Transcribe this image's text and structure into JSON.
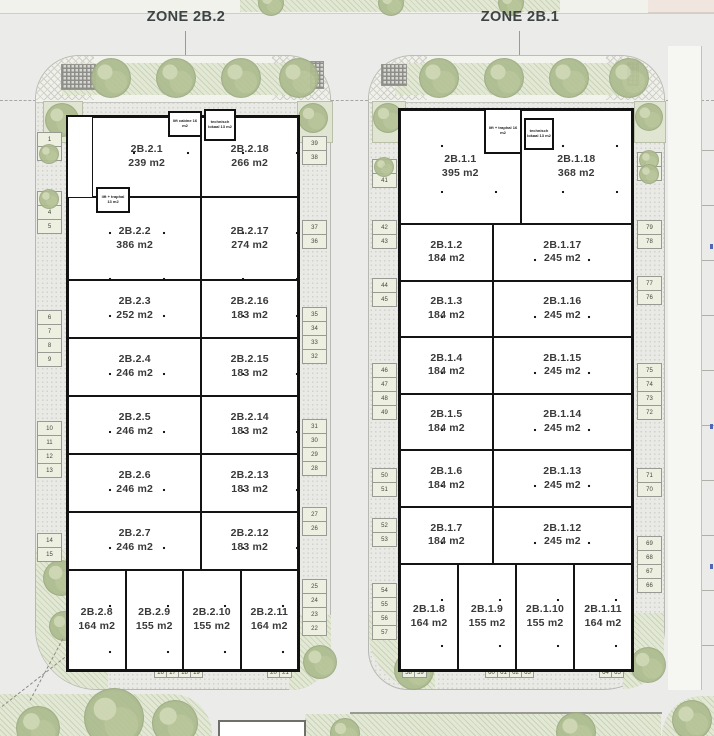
{
  "zones": [
    {
      "label": "ZONE 2B.2"
    },
    {
      "label": "ZONE 2B.1"
    }
  ],
  "buildings": [
    {
      "name": "2B.2",
      "rows": [
        [
          {
            "id": "2B.2.1",
            "area": "239 m2"
          },
          {
            "id": "2B.2.18",
            "area": "266 m2"
          }
        ],
        [
          {
            "id": "2B.2.2",
            "area": "386 m2"
          },
          {
            "id": "2B.2.17",
            "area": "274 m2"
          }
        ],
        [
          {
            "id": "2B.2.3",
            "area": "252 m2"
          },
          {
            "id": "2B.2.16",
            "area": "183 m2"
          }
        ],
        [
          {
            "id": "2B.2.4",
            "area": "246 m2"
          },
          {
            "id": "2B.2.15",
            "area": "183 m2"
          }
        ],
        [
          {
            "id": "2B.2.5",
            "area": "246 m2"
          },
          {
            "id": "2B.2.14",
            "area": "183 m2"
          }
        ],
        [
          {
            "id": "2B.2.6",
            "area": "246 m2"
          },
          {
            "id": "2B.2.13",
            "area": "183 m2"
          }
        ],
        [
          {
            "id": "2B.2.7",
            "area": "246 m2"
          },
          {
            "id": "2B.2.12",
            "area": "183 m2"
          }
        ],
        [
          {
            "id": "2B.2.8",
            "area": "164 m2"
          },
          {
            "id": "2B.2.9",
            "area": "155 m2"
          },
          {
            "id": "2B.2.10",
            "area": "155 m2"
          },
          {
            "id": "2B.2.11",
            "area": "164 m2"
          }
        ]
      ],
      "utilities": [
        {
          "label": "lift cabine 16 m2"
        },
        {
          "label": "technisch lokaal 13 m2"
        },
        {
          "label": "lift + traphal 13 m2"
        }
      ]
    },
    {
      "name": "2B.1",
      "rows": [
        [
          {
            "id": "2B.1.1",
            "area": "395 m2"
          },
          {
            "id": "2B.1.18",
            "area": "368 m2"
          }
        ],
        [
          {
            "id": "2B.1.2",
            "area": "184 m2"
          },
          {
            "id": "2B.1.17",
            "area": "245 m2"
          }
        ],
        [
          {
            "id": "2B.1.3",
            "area": "184 m2"
          },
          {
            "id": "2B.1.16",
            "area": "245 m2"
          }
        ],
        [
          {
            "id": "2B.1.4",
            "area": "184 m2"
          },
          {
            "id": "2B.1.15",
            "area": "245 m2"
          }
        ],
        [
          {
            "id": "2B.1.5",
            "area": "184 m2"
          },
          {
            "id": "2B.1.14",
            "area": "245 m2"
          }
        ],
        [
          {
            "id": "2B.1.6",
            "area": "184 m2"
          },
          {
            "id": "2B.1.13",
            "area": "245 m2"
          }
        ],
        [
          {
            "id": "2B.1.7",
            "area": "184 m2"
          },
          {
            "id": "2B.1.12",
            "area": "245 m2"
          }
        ],
        [
          {
            "id": "2B.1.8",
            "area": "164 m2"
          },
          {
            "id": "2B.1.9",
            "area": "155 m2"
          },
          {
            "id": "2B.1.10",
            "area": "155 m2"
          },
          {
            "id": "2B.1.11",
            "area": "164 m2"
          }
        ]
      ],
      "utilities": [
        {
          "label": "lift + traphal 16 m2"
        },
        {
          "label": "technisch lokaal 13 m2"
        }
      ]
    }
  ],
  "parking": {
    "b2": {
      "l1": [
        {
          "n": "1"
        },
        {
          "n": "2",
          "tree": true
        }
      ],
      "l2": [
        {
          "n": "3",
          "tree": true
        },
        {
          "n": "4"
        },
        {
          "n": "5"
        }
      ],
      "l3": [
        {
          "n": "6"
        },
        {
          "n": "7"
        },
        {
          "n": "8"
        },
        {
          "n": "9"
        }
      ],
      "l4": [
        {
          "n": "10"
        },
        {
          "n": "11"
        },
        {
          "n": "12"
        },
        {
          "n": "13"
        }
      ],
      "l5": [
        {
          "n": "14"
        },
        {
          "n": "15"
        }
      ],
      "b1": [
        {
          "n": "16"
        },
        {
          "n": "17"
        },
        {
          "n": "18"
        },
        {
          "n": "19"
        }
      ],
      "b2": [
        {
          "n": "20"
        },
        {
          "n": "21"
        }
      ],
      "r6": [
        {
          "n": "39"
        },
        {
          "n": "38"
        }
      ],
      "r5": [
        {
          "n": "37"
        },
        {
          "n": "36"
        }
      ],
      "r4": [
        {
          "n": "35"
        },
        {
          "n": "34"
        },
        {
          "n": "33"
        },
        {
          "n": "32"
        }
      ],
      "r3": [
        {
          "n": "31"
        },
        {
          "n": "30"
        },
        {
          "n": "29"
        },
        {
          "n": "28"
        }
      ],
      "r2": [
        {
          "n": "27"
        },
        {
          "n": "26"
        }
      ],
      "r1": [
        {
          "n": "25"
        },
        {
          "n": "24"
        },
        {
          "n": "23"
        },
        {
          "n": "22"
        }
      ]
    },
    "b1": {
      "l1": [
        {
          "n": "40",
          "tree": true
        },
        {
          "n": "41"
        }
      ],
      "l2": [
        {
          "n": "42"
        },
        {
          "n": "43"
        }
      ],
      "l3": [
        {
          "n": "44"
        },
        {
          "n": "45"
        }
      ],
      "l4": [
        {
          "n": "46"
        },
        {
          "n": "47"
        },
        {
          "n": "48"
        },
        {
          "n": "49"
        }
      ],
      "l5": [
        {
          "n": "50"
        },
        {
          "n": "51"
        }
      ],
      "l6": [
        {
          "n": "52"
        },
        {
          "n": "53"
        }
      ],
      "l7": [
        {
          "n": "54"
        },
        {
          "n": "55"
        },
        {
          "n": "56"
        },
        {
          "n": "57"
        }
      ],
      "b1": [
        {
          "n": "58"
        },
        {
          "n": "59"
        }
      ],
      "b2": [
        {
          "n": "60"
        },
        {
          "n": "61"
        },
        {
          "n": "62"
        },
        {
          "n": "63"
        }
      ],
      "b3": [
        {
          "n": "64"
        },
        {
          "n": "65"
        }
      ],
      "r1": [
        {
          "tree": true
        },
        {
          "tree": true
        }
      ],
      "r2": [
        {
          "n": "79"
        },
        {
          "n": "78"
        }
      ],
      "r3": [
        {
          "n": "77"
        },
        {
          "n": "76"
        }
      ],
      "r4": [
        {
          "n": "75"
        },
        {
          "n": "74"
        },
        {
          "n": "73"
        },
        {
          "n": "72"
        }
      ],
      "r5": [
        {
          "n": "71"
        },
        {
          "n": "70"
        }
      ],
      "r6": [
        {
          "n": "69"
        },
        {
          "n": "68"
        },
        {
          "n": "67"
        },
        {
          "n": "66"
        }
      ]
    }
  }
}
